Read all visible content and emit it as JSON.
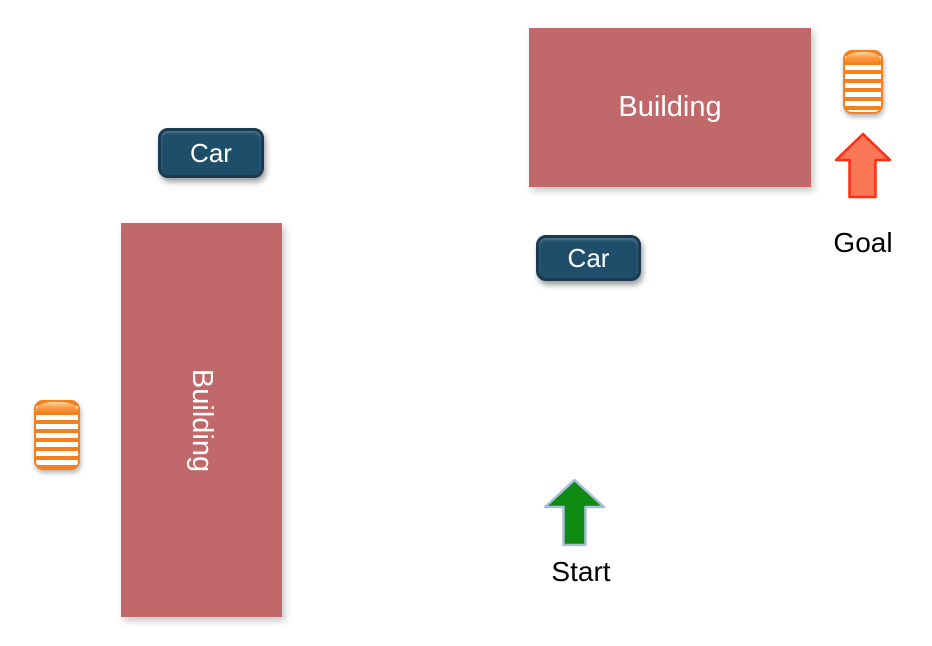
{
  "colors": {
    "background": "#ffffff",
    "building_fill": "#c1686b",
    "building_text": "#ffffff",
    "car_fill": "#1f4e6b",
    "car_border": "#1a3a52",
    "car_text": "#ffffff",
    "cylinder_orange": "#f5811e",
    "start_arrow_fill": "#0e8a12",
    "start_arrow_stroke": "#a8bfda",
    "goal_arrow_fill": "#fb7557",
    "goal_arrow_stroke": "#ff2d12",
    "label_text": "#000000"
  },
  "elements": {
    "building_top": {
      "label": "Building"
    },
    "building_left": {
      "label": "Building"
    },
    "car_top": {
      "label": "Car"
    },
    "car_middle": {
      "label": "Car"
    },
    "start": {
      "label": "Start"
    },
    "goal": {
      "label": "Goal"
    }
  }
}
